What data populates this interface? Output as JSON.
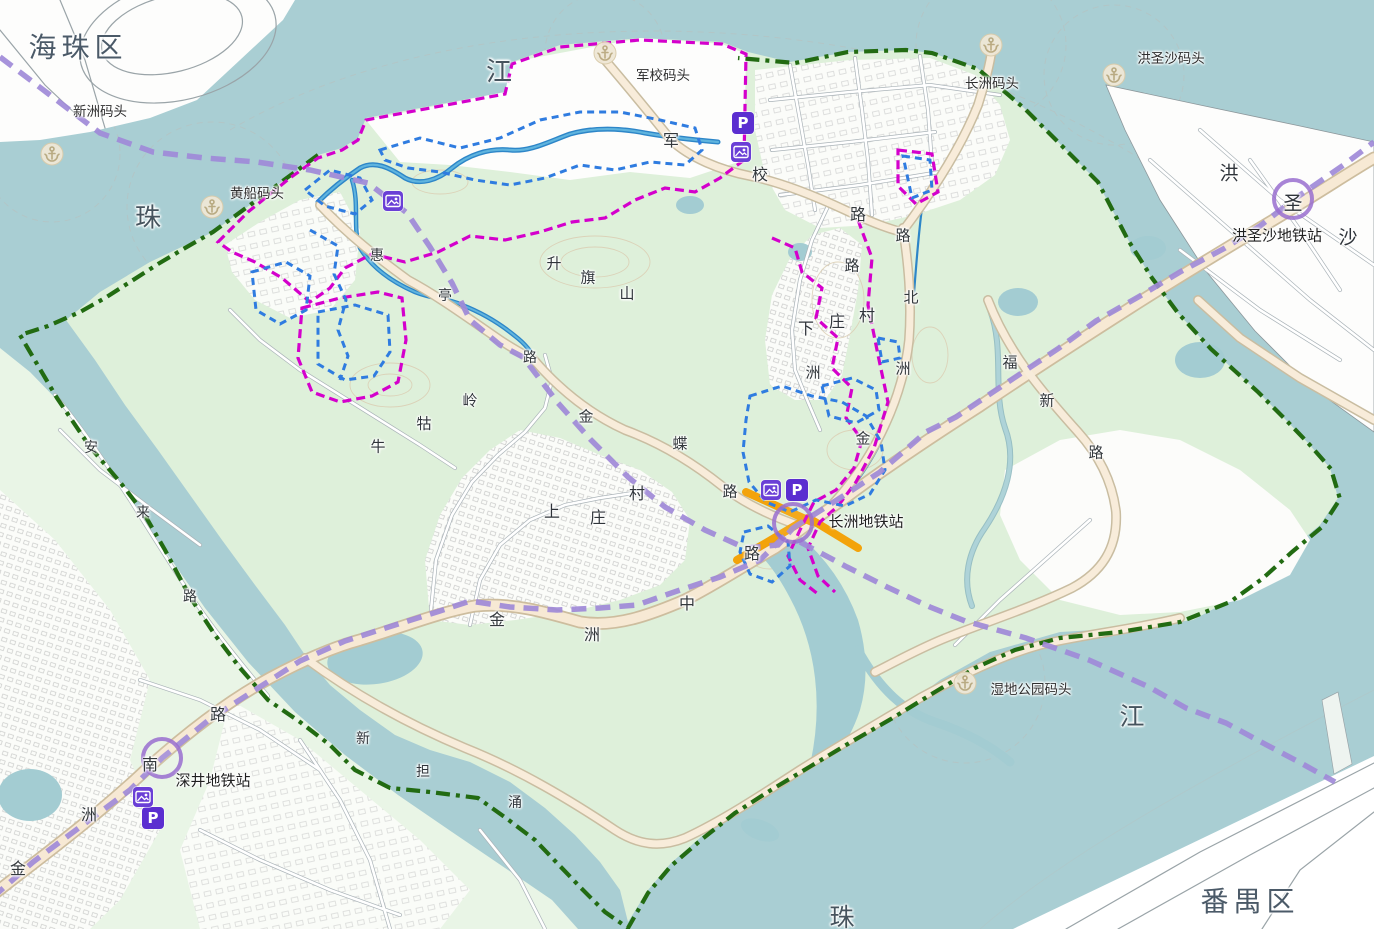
{
  "map": {
    "title": "长洲岛规划地图",
    "colors": {
      "water": "#a9ced3",
      "island_green": "#def0da",
      "mainland_green": "#e9f5e6",
      "built_white": "#fdfdfb",
      "road_fill": "#f7e9d4",
      "road_casing": "#cdbd9e",
      "river_blue": "#2d86c8",
      "boundary_green": "#226b12",
      "planning_magenta": "#d400cc",
      "planning_blue": "#2f7ce0",
      "metro_purple": "#a08ad8",
      "highlight_orange": "#f59f00",
      "icon_purple": "#5b2ed0",
      "station_ring": "#9a6fd0",
      "anchor_bg": "#efe7d6",
      "anchor_fg": "#b9a87e"
    },
    "districts": [
      {
        "name": "haizhu-district-label",
        "text": "海珠区",
        "x": 78,
        "y": 46,
        "size": 28
      },
      {
        "name": "panyu-district-label",
        "text": "番禺区",
        "x": 1250,
        "y": 900,
        "size": 28
      }
    ],
    "water_labels": [
      {
        "name": "pearl-river-char-1",
        "text": "珠",
        "x": 149,
        "y": 216,
        "size": 26
      },
      {
        "name": "pearl-river-char-2",
        "text": "江",
        "x": 500,
        "y": 70,
        "size": 26
      },
      {
        "name": "pearl-river-char-3",
        "text": "江",
        "x": 1133,
        "y": 715,
        "size": 25
      },
      {
        "name": "pearl-river-char-4",
        "text": "珠",
        "x": 843,
        "y": 916,
        "size": 25
      }
    ],
    "piers": [
      {
        "name": "xinzhou-pier",
        "label": "新洲码头",
        "label_x": 100,
        "label_y": 110,
        "icon_x": 52,
        "icon_y": 154
      },
      {
        "name": "huangchuan-pier",
        "label": "黄船码头",
        "label_x": 257,
        "label_y": 192,
        "icon_x": 212,
        "icon_y": 207
      },
      {
        "name": "junxiao-pier",
        "label": "军校码头",
        "label_x": 663,
        "label_y": 74,
        "icon_x": 605,
        "icon_y": 53
      },
      {
        "name": "changzhou-pier",
        "label": "长洲码头",
        "label_x": 992,
        "label_y": 82,
        "icon_x": 991,
        "icon_y": 45
      },
      {
        "name": "hongshengsha-pier",
        "label": "洪圣沙码头",
        "label_x": 1171,
        "label_y": 57,
        "icon_x": 1114,
        "icon_y": 75
      },
      {
        "name": "wetland-park-pier",
        "label": "湿地公园码头",
        "label_x": 1031,
        "label_y": 688,
        "icon_x": 965,
        "icon_y": 683
      }
    ],
    "metro_stations": [
      {
        "name": "shenjing-metro-station",
        "label": "深井地铁站",
        "label_x": 213,
        "label_y": 780,
        "ring_x": 162,
        "ring_y": 758
      },
      {
        "name": "changzhou-metro-station",
        "label": "长洲地铁站",
        "label_x": 866,
        "label_y": 521,
        "ring_x": 793,
        "ring_y": 523
      },
      {
        "name": "hongshengsha-metro-station",
        "label": "洪圣沙地铁站",
        "label_x": 1277,
        "label_y": 235,
        "ring_x": 1293,
        "ring_y": 199
      }
    ],
    "road_labels": [
      {
        "name": "junxiao-road-char",
        "text": "军",
        "x": 671,
        "y": 139,
        "size": 16
      },
      {
        "name": "junxiao-road-char",
        "text": "校",
        "x": 760,
        "y": 173,
        "size": 16
      },
      {
        "name": "junxiao-road-char",
        "text": "路",
        "x": 858,
        "y": 213,
        "size": 16
      },
      {
        "name": "jinzhou-north-road-char",
        "text": "路",
        "x": 903,
        "y": 235,
        "size": 15
      },
      {
        "name": "jinzhou-north-road-char",
        "text": "北",
        "x": 911,
        "y": 297,
        "size": 15
      },
      {
        "name": "jinzhou-north-road-char",
        "text": "洲",
        "x": 903,
        "y": 368,
        "size": 15
      },
      {
        "name": "jinzhou-north-road-char",
        "text": "金",
        "x": 863,
        "y": 438,
        "size": 15
      },
      {
        "name": "zhou-road-char",
        "text": "路",
        "x": 852,
        "y": 265,
        "size": 15
      },
      {
        "name": "zhou-road-char",
        "text": "洲",
        "x": 813,
        "y": 372,
        "size": 15
      },
      {
        "name": "jindie-road-char",
        "text": "金",
        "x": 586,
        "y": 416,
        "size": 15
      },
      {
        "name": "jindie-road-char",
        "text": "蝶",
        "x": 680,
        "y": 443,
        "size": 15
      },
      {
        "name": "jindie-road-char",
        "text": "路",
        "x": 730,
        "y": 491,
        "size": 15
      },
      {
        "name": "jinzhou-middle-road-char",
        "text": "路",
        "x": 752,
        "y": 552,
        "size": 16
      },
      {
        "name": "jinzhou-middle-road-char",
        "text": "中",
        "x": 687,
        "y": 602,
        "size": 16
      },
      {
        "name": "jinzhou-middle-road-char",
        "text": "洲",
        "x": 592,
        "y": 633,
        "size": 16
      },
      {
        "name": "jinzhou-middle-road-char",
        "text": "金",
        "x": 497,
        "y": 618,
        "size": 16
      },
      {
        "name": "jinzhou-south-road-char",
        "text": "路",
        "x": 218,
        "y": 713,
        "size": 16
      },
      {
        "name": "jinzhou-south-road-char",
        "text": "南",
        "x": 150,
        "y": 763,
        "size": 16
      },
      {
        "name": "jinzhou-south-road-char",
        "text": "洲",
        "x": 89,
        "y": 813,
        "size": 16
      },
      {
        "name": "jinzhou-south-road-char",
        "text": "金",
        "x": 18,
        "y": 867,
        "size": 16
      },
      {
        "name": "fuxin-road-char",
        "text": "福",
        "x": 1010,
        "y": 362,
        "size": 15
      },
      {
        "name": "fuxin-road-char",
        "text": "新",
        "x": 1047,
        "y": 400,
        "size": 15
      },
      {
        "name": "fuxin-road-char",
        "text": "路",
        "x": 1096,
        "y": 452,
        "size": 15
      },
      {
        "name": "huiting-road-char",
        "text": "惠",
        "x": 377,
        "y": 255,
        "size": 14
      },
      {
        "name": "huiting-road-char",
        "text": "亭",
        "x": 445,
        "y": 295,
        "size": 14
      },
      {
        "name": "huiting-road-char",
        "text": "路",
        "x": 530,
        "y": 357,
        "size": 14
      },
      {
        "name": "anlai-road-char",
        "text": "安",
        "x": 91,
        "y": 447,
        "size": 14
      },
      {
        "name": "anlai-road-char",
        "text": "来",
        "x": 143,
        "y": 512,
        "size": 14
      },
      {
        "name": "anlai-road-char",
        "text": "路",
        "x": 190,
        "y": 596,
        "size": 14
      }
    ],
    "place_labels": [
      {
        "name": "shangzhuang-village-char",
        "text": "上",
        "x": 552,
        "y": 510,
        "size": 16
      },
      {
        "name": "shangzhuang-village-char",
        "text": "庄",
        "x": 598,
        "y": 516,
        "size": 16
      },
      {
        "name": "shangzhuang-village-char",
        "text": "村",
        "x": 637,
        "y": 492,
        "size": 16
      },
      {
        "name": "xiazhuang-village-char",
        "text": "下",
        "x": 806,
        "y": 327,
        "size": 16
      },
      {
        "name": "xiazhuang-village-char",
        "text": "庄",
        "x": 837,
        "y": 320,
        "size": 16
      },
      {
        "name": "xiazhuang-village-char",
        "text": "村",
        "x": 867,
        "y": 314,
        "size": 16
      },
      {
        "name": "shengqi-hill-char",
        "text": "升",
        "x": 554,
        "y": 263,
        "size": 15
      },
      {
        "name": "shengqi-hill-char",
        "text": "旗",
        "x": 588,
        "y": 277,
        "size": 15
      },
      {
        "name": "shengqi-hill-char",
        "text": "山",
        "x": 627,
        "y": 293,
        "size": 15
      },
      {
        "name": "niugu-ridge-char",
        "text": "岭",
        "x": 470,
        "y": 400,
        "size": 15
      },
      {
        "name": "niugu-ridge-char",
        "text": "牯",
        "x": 424,
        "y": 423,
        "size": 15
      },
      {
        "name": "niugu-ridge-char",
        "text": "牛",
        "x": 378,
        "y": 446,
        "size": 15
      },
      {
        "name": "hongshengsha-island-char",
        "text": "洪",
        "x": 1229,
        "y": 172,
        "size": 19
      },
      {
        "name": "hongshengsha-island-char",
        "text": "圣",
        "x": 1293,
        "y": 202,
        "size": 19
      },
      {
        "name": "hongshengsha-island-char",
        "text": "沙",
        "x": 1348,
        "y": 236,
        "size": 19
      }
    ],
    "stream_labels": [
      {
        "name": "xindan-creek-char",
        "text": "新",
        "x": 363,
        "y": 738,
        "size": 14
      },
      {
        "name": "xindan-creek-char",
        "text": "担",
        "x": 423,
        "y": 771,
        "size": 14
      },
      {
        "name": "xindan-creek-char",
        "text": "涌",
        "x": 515,
        "y": 802,
        "size": 14
      }
    ],
    "icons": {
      "parking_glyph": "P",
      "parking": [
        {
          "name": "parking-icon",
          "x": 743,
          "y": 123
        },
        {
          "name": "parking-icon",
          "x": 797,
          "y": 490
        },
        {
          "name": "parking-icon",
          "x": 153,
          "y": 818
        }
      ],
      "camera": [
        {
          "name": "camera-icon",
          "x": 741,
          "y": 152
        },
        {
          "name": "camera-icon",
          "x": 393,
          "y": 201
        },
        {
          "name": "camera-icon",
          "x": 771,
          "y": 490
        },
        {
          "name": "camera-icon",
          "x": 143,
          "y": 797
        }
      ]
    }
  }
}
